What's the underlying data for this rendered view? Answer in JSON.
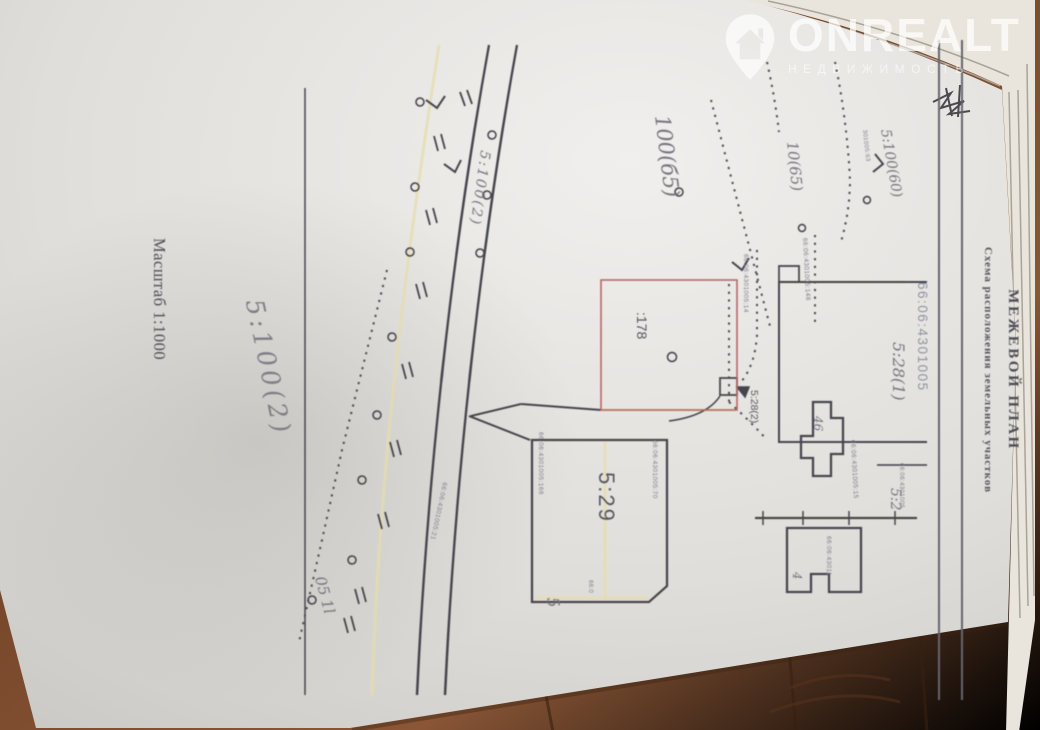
{
  "watermark": {
    "brand": "ONREALT",
    "tagline": "НЕДВИЖИМОСТЬ",
    "icon": "house-location-pin-icon",
    "color": "#ffffff"
  },
  "doc": {
    "title": "МЕЖЕВОЙ ПЛАН",
    "subtitle": "Схема расположения земельных участков",
    "cadastral_quarter": "66:06:4301005",
    "scale": "Масштаб 1:1000",
    "handwritten_note": "5:100(2)",
    "labels": {
      "p5100_60": "5:100(60)",
      "p528_1": "5:28(1)",
      "p52": "5:2",
      "p10_65": "10(65)",
      "p100b5": "100(б5)",
      "p178": ":178",
      "p528_2": "5:28(2)",
      "b46": "46",
      "b4": "4",
      "p529": "5:29",
      "road": "5:100(2)",
      "p5": "5",
      "note05": "05 1l"
    },
    "cadastral_numbers": {
      "n63": "301005:63",
      "n148": "66:06:4301005:148",
      "n14": "66:06:4301005:14",
      "n15": "66:06:4301005:15",
      "n43011": "66:06:43011",
      "n70": "66:06:4301005:70",
      "n166": "66:06:4301005:166",
      "n21": "66:06:4301005:21",
      "nq": "66:06:4301005",
      "n66": "66:0"
    },
    "colors": {
      "highlight_parcel_outline": "#b26a6a",
      "ink": "#45454d",
      "paper": "#e7e5e1",
      "wood": "#74442a"
    }
  }
}
